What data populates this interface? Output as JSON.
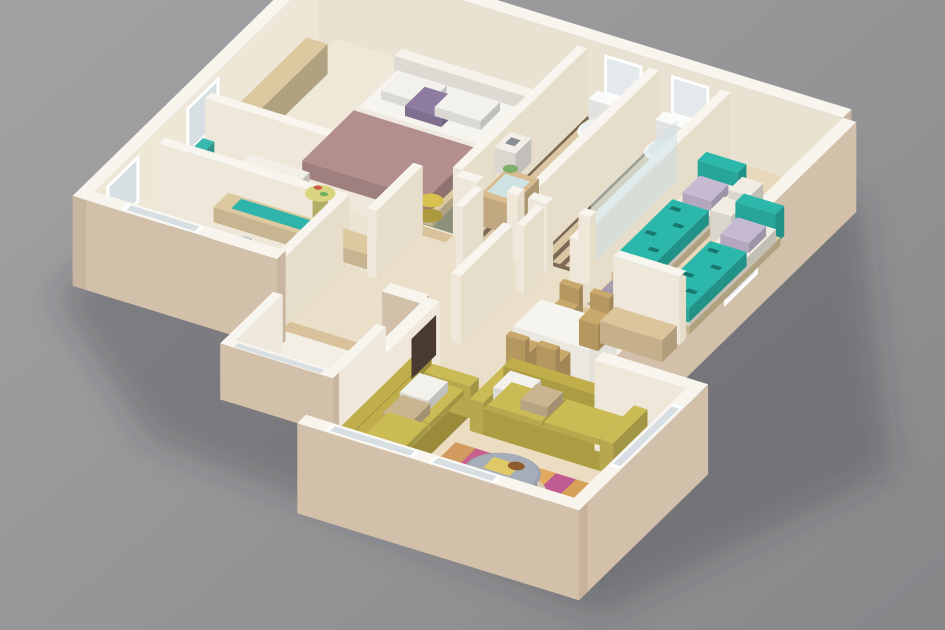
{
  "scene": {
    "type": "3d-floorplan-render",
    "view": "isometric",
    "description": "Photorealistic 3D floor plan render of a three-bedroom apartment model standing on a plain gray surface"
  },
  "background": {
    "top": "#a2a2a4",
    "bottom": "#87878a",
    "shadow": "rgba(52,52,60,0.28)"
  },
  "colors": {
    "wallTop": "#f8f5ef",
    "wallInNW": "#eee7d8",
    "wallInNE": "#e9e1d1",
    "wallInA": "#e7ddcb",
    "wallInB": "#efe8da",
    "wallOut": "#d3c0aa",
    "wallOutDark": "#c7b29b",
    "wallEnd": "#c9b6a0",
    "floorHall": "#eadfc9",
    "floorMaster": "#efe8d9",
    "floorStudy": "#ece4d3",
    "floorKitchen": "#eae1cf",
    "floorKids": "#e9d9ba",
    "floorLiving": "#ecdcc2",
    "floorBalcony": "#f3efe5",
    "bathBase": "#7c6a55",
    "bathSlat": "#d9c7a4",
    "rugGreen": "#8d9179",
    "rugKids": "#a89bad",
    "kidsWoodMat": "#e3cda1",
    "wood": "#dcc9a0",
    "thresholdWood": "#d9c29b",
    "headboard": "#f5f2eb",
    "mattress": "#f6f4ee",
    "duvet": "#b28e8c",
    "sheet": "#efe9e2",
    "pillow": "#f3f1ec",
    "accentPillow": "#8d7c9f",
    "basket": "#d8c14f",
    "tealChair": "#38b8ae",
    "cabinet": "#f2efe8",
    "standYellow": "#d9d47f",
    "tealRunner": "#2fb4ab",
    "counterTop": "#f3f1ea",
    "stove": "#3b3b3d",
    "sink": "#c2c6ca",
    "metal": "#c8ccd0",
    "bottle": "#e0c46a",
    "toilet": "#fbfbfa",
    "toiletSeat": "#eceff0",
    "vanity": "#d8bb8e",
    "basin": "#cfe3e3",
    "plant": "#7fae6a",
    "glass": "#d7dfe2",
    "frosted": "#e4e9ec",
    "frame": "#ffffff",
    "showerGlass": "rgba(198,224,230,0.45)",
    "kidsTeal": "#2bb7a9",
    "kidsTealDark": "#17776d",
    "kidsPillow": "#c6b9d2",
    "cube": "#f1ede3",
    "table": "#f6f4ee",
    "chairWood": "#c9a86b",
    "sideboard": "#dcc49b",
    "sofa": "#bfae49",
    "sofaLight": "#cbbb55",
    "cushion": "#c9b58f",
    "tv": "#483931",
    "coffeeTable": "#9aa3ae",
    "coffeeTop": "#a5aeb8",
    "coffeeShadow": "#d8c8b2",
    "book": "#dfca67",
    "bowl": "#8f5a2e",
    "toyRed": "#d05a4a",
    "toyGreen": "#6db05a",
    "stripes": [
      "#d29a5e",
      "#c9618f",
      "#dcb469",
      "#b84f86",
      "#e0a95e",
      "#c05a92",
      "#d7a257",
      "#c97e9e"
    ]
  },
  "rooms": [
    {
      "name": "master-bedroom",
      "furniture": [
        "double-bed",
        "bedside-table",
        "wardrobe-ledge",
        "green-rug",
        "laundry-basket"
      ]
    },
    {
      "name": "study",
      "furniture": [
        "teal-armchair",
        "white-cabinet",
        "yellow-side-table",
        "desk-plank",
        "teal-runner"
      ]
    },
    {
      "name": "kitchen",
      "furniture": [
        "counter",
        "cooktop",
        "oven",
        "sink",
        "bottles"
      ]
    },
    {
      "name": "bathroom-1",
      "furniture": [
        "toilet",
        "wood-vanity",
        "washbasin",
        "plant"
      ]
    },
    {
      "name": "bathroom-2",
      "furniture": [
        "toilet",
        "shower-screen"
      ]
    },
    {
      "name": "kids-bedroom",
      "furniture": [
        "teal-bed-1",
        "teal-bed-2",
        "cube-nightstand-1",
        "cube-nightstand-2",
        "gray-rug",
        "wood-mat",
        "toy"
      ]
    },
    {
      "name": "dining-area",
      "furniture": [
        "dining-table",
        "chair",
        "chair",
        "chair",
        "chair",
        "wood-sideboard"
      ]
    },
    {
      "name": "living-room",
      "furniture": [
        "sofa-west",
        "sofa-north",
        "coffee-table",
        "striped-rug",
        "tv-panel"
      ]
    },
    {
      "name": "balcony",
      "furniture": []
    },
    {
      "name": "hallway",
      "furniture": []
    }
  ]
}
